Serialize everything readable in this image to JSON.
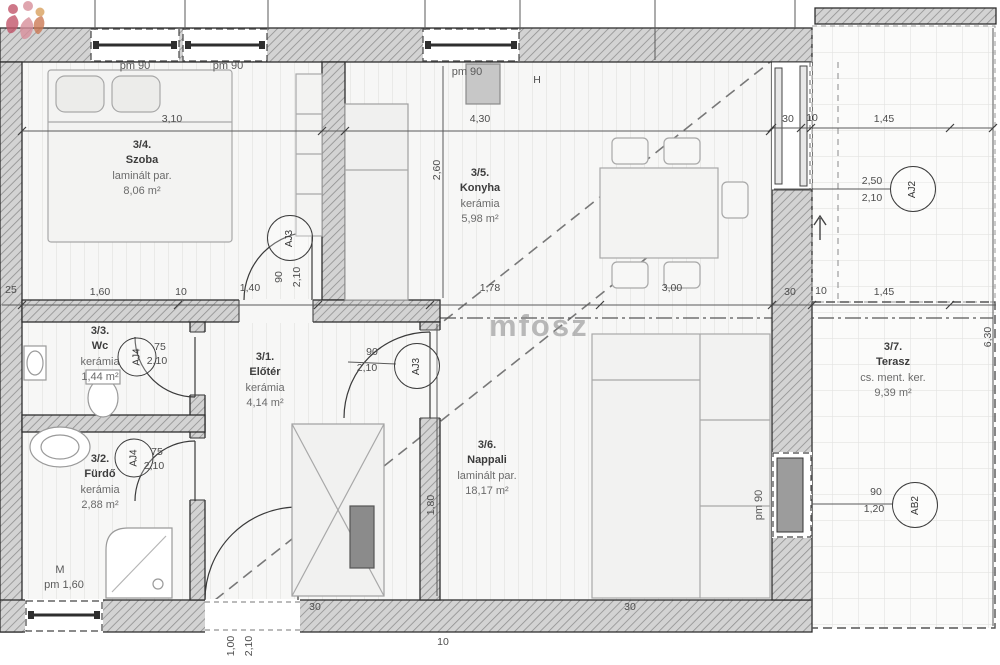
{
  "watermark": {
    "text": "mfosz"
  },
  "rooms": [
    {
      "number": "3/1.",
      "name": "Előtér",
      "floor": "kerámia",
      "area": "4,14 m²"
    },
    {
      "number": "3/2.",
      "name": "Fürdő",
      "floor": "kerámia",
      "area": "2,88 m²"
    },
    {
      "number": "3/3.",
      "name": "Wc",
      "floor": "kerámia",
      "area": "1,44 m²"
    },
    {
      "number": "3/4.",
      "name": "Szoba",
      "floor": "laminált par.",
      "area": "8,06 m²"
    },
    {
      "number": "3/5.",
      "name": "Konyha",
      "floor": "kerámia",
      "area": "5,98 m²"
    },
    {
      "number": "3/6.",
      "name": "Nappali",
      "floor": "laminált par.",
      "area": "18,17 m²"
    },
    {
      "number": "3/7.",
      "name": "Terasz",
      "floor": "cs. ment. ker.",
      "area": "9,39 m²"
    }
  ],
  "window_labels": {
    "szoba_left": "pm 90",
    "szoba_right": "pm 90",
    "konyha": "pm 90",
    "right_wall": "pm 90",
    "bath_letter": "M",
    "bath_size": "pm 1,60"
  },
  "door_tags": {
    "szoba": "AJ3",
    "nappali": "AJ3",
    "terrace": "AJ2",
    "window_right": "AB2",
    "wc": "AJ4",
    "furdo": "AJ4"
  },
  "door_sizes": {
    "szoba_w": "90",
    "szoba_h": "2,10",
    "nappali_w": "90",
    "nappali_h": "2,10",
    "wc_w": "75",
    "wc_h": "2,10",
    "furdo_w": "75",
    "furdo_h": "2,10",
    "entry_w": "1,00",
    "entry_h": "2,10",
    "terrace_w": "2,50",
    "terrace_h": "2,10",
    "window_right_w": "90",
    "window_right_h": "1,20"
  },
  "fixtures": {
    "fridge": "H"
  },
  "dims": {
    "szoba_top": "3,10",
    "konyha_top": "4,30",
    "tr_30": "30",
    "tr_10": "10",
    "tr_145": "1,45",
    "mid_25": "25",
    "mid_160": "1,60",
    "mid_10": "10",
    "mid_140": "1,40",
    "mid_178": "1,78",
    "mid_300": "3,00",
    "mid_30": "30",
    "mid_10b": "10",
    "mid_145": "1,45",
    "v_260": "2,60",
    "v_180": "1,80",
    "v_630": "6,30",
    "b_30a": "30",
    "b_10": "10",
    "b_30b": "30"
  }
}
